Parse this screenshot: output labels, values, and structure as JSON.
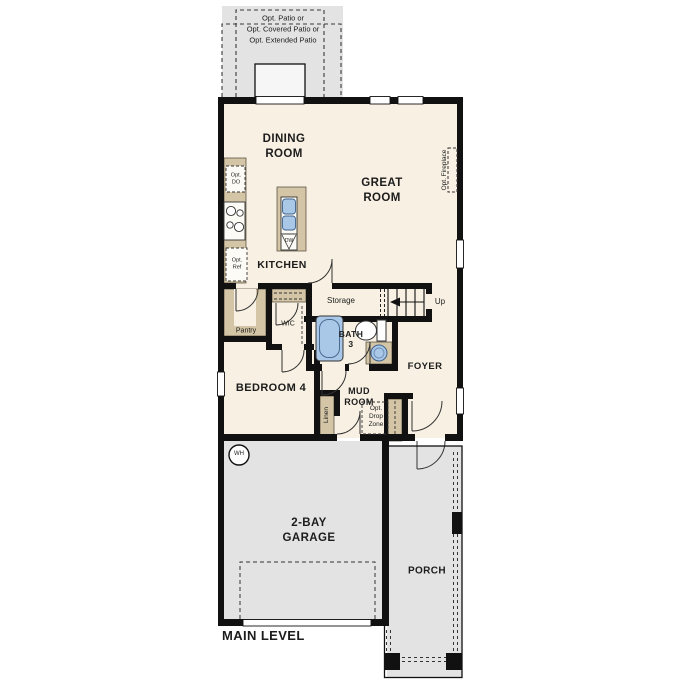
{
  "plan": {
    "title": "MAIN LEVEL",
    "labels": {
      "patio_options": "Opt. Patio or\nOpt. Covered Patio or\nOpt. Extended Patio",
      "dining_room": "DINING\nROOM",
      "great_room": "GREAT\nROOM",
      "opt_fireplace": "Opt. Fireplace",
      "kitchen": "KITCHEN",
      "opt_double_oven": "Opt.\nDO",
      "opt_refrigerator": "Opt.\nRef",
      "dishwasher": "DW",
      "storage": "Storage",
      "stairs_up": "Up",
      "pantry": "Pantry",
      "walk_in_closet": "WIC",
      "bath_3": "BATH\n3",
      "foyer": "FOYER",
      "bedroom_4": "BEDROOM 4",
      "mud_room": "MUD\nROOM",
      "opt_drop_zone": "Opt.\nDrop\nZone",
      "linen": "Linen",
      "water_heater": "WH",
      "garage": "2-BAY\nGARAGE",
      "porch": "PORCH"
    },
    "colors": {
      "wall": "#111111",
      "interior_floor": "#f8f1e3",
      "concrete": "#e3e3e3",
      "casework": "#d3c5a6",
      "plumbing_fixture": "#a9c7e7"
    }
  }
}
